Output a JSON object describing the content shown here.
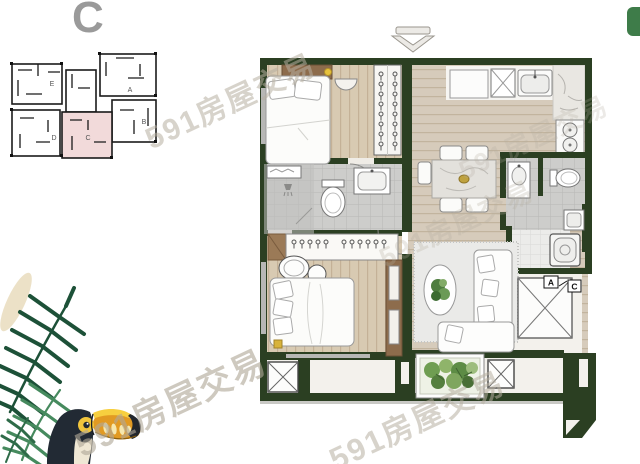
{
  "title": {
    "text": "C"
  },
  "key_plan": {
    "highlighted_unit": "C",
    "units": [
      {
        "label": "E"
      },
      {
        "label": "A"
      },
      {
        "label": "B"
      },
      {
        "label": "D"
      },
      {
        "label": "C"
      }
    ]
  },
  "floor_plan": {
    "entry_labels": {
      "a": "A",
      "c": "C"
    }
  },
  "watermark": {
    "text": "591房屋交易"
  },
  "colors": {
    "wall_green": "#2b3f22",
    "highlight_pink": "#f2dada",
    "corner_chip_green": "#3e7c49",
    "watermark_gray": "#b6ae9f",
    "title_gray": "#9a9a9a",
    "wood_floor": "#d8cab2",
    "furniture_brown": "#8d6c4c"
  },
  "icons": {
    "north_arrow": "chevron-down outline",
    "ac_unit": "box with X",
    "door_swing": "diagonal line between A and C boxes",
    "hanger": "circle with stem",
    "shower_head": "trapezoid with spray lines"
  }
}
